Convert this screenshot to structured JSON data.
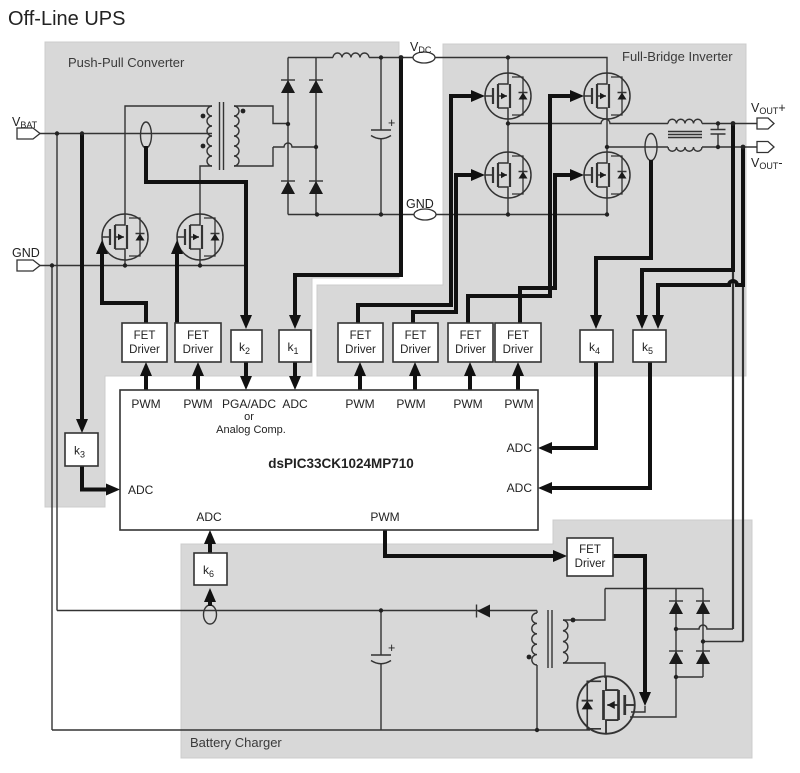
{
  "title": "Off-Line UPS",
  "regions": {
    "push_pull": "Push-Pull Converter",
    "full_bridge": "Full-Bridge Inverter",
    "battery": "Battery Charger"
  },
  "chip": {
    "name": "dsPIC33CK1024MP710",
    "top_pins": [
      "PWM",
      "PWM",
      "PGA/ADC",
      "ADC",
      "PWM",
      "PWM",
      "PWM",
      "PWM"
    ],
    "pga_note": [
      "or",
      "Analog Comp."
    ],
    "left_pin": "ADC",
    "right_pins": [
      "ADC",
      "ADC"
    ],
    "bottom_pins": [
      "ADC",
      "PWM"
    ]
  },
  "driver_label": {
    "line1": "FET",
    "line2": "Driver"
  },
  "k_blocks": [
    {
      "base": "k",
      "sub": "1"
    },
    {
      "base": "k",
      "sub": "2"
    },
    {
      "base": "k",
      "sub": "3"
    },
    {
      "base": "k",
      "sub": "4"
    },
    {
      "base": "k",
      "sub": "5"
    },
    {
      "base": "k",
      "sub": "6"
    }
  ],
  "terminals": {
    "vbat": {
      "base": "V",
      "sub": "BAT"
    },
    "gnd_left": "GND",
    "vdc": {
      "base": "V",
      "sub": "DC"
    },
    "gnd_mid": "GND",
    "vout_plus": {
      "base": "V",
      "sub": "OUT",
      "suffix": "+"
    },
    "vout_minus": {
      "base": "V",
      "sub": "OUT",
      "suffix": "-"
    }
  },
  "misc": {
    "cap_polarity": "+"
  },
  "colors": {
    "region_fill": "#d8d8d8",
    "wire": "#333333",
    "signal": "#111111",
    "box_fill": "#ffffff",
    "text": "#222222"
  }
}
